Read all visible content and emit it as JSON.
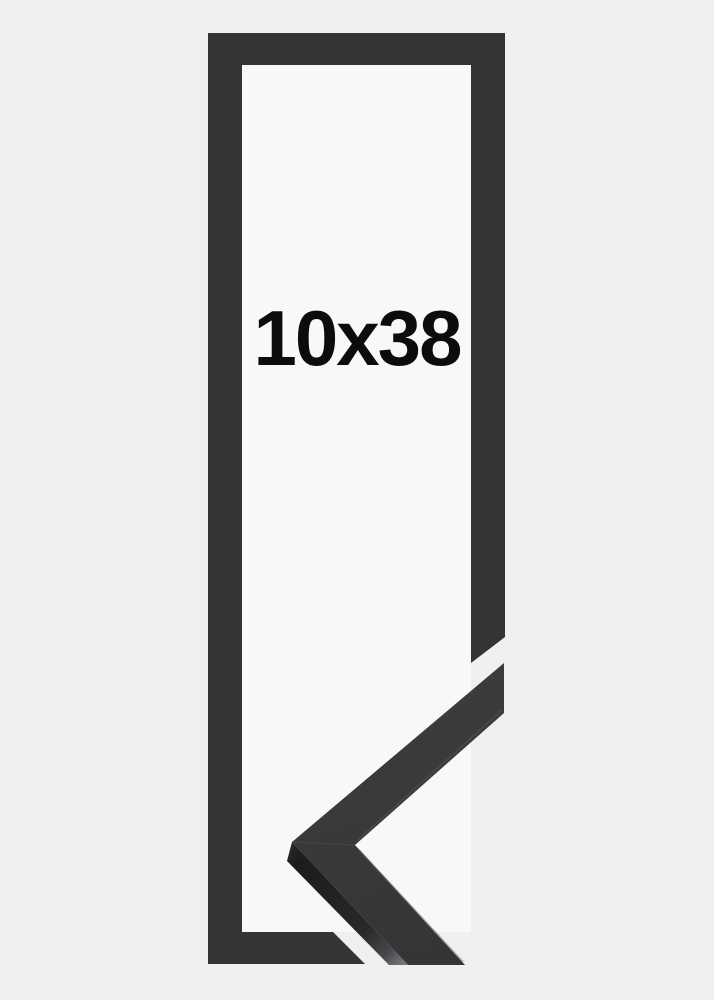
{
  "product": {
    "size_label": "10x38"
  },
  "colors": {
    "background": "#f0f0ef",
    "frame_opening": "#f8f8f7",
    "frame": "#343437",
    "corner_sample_face": "#3a3a3c",
    "corner_sample_side_dark": "#1c1c1e",
    "corner_sample_side_light": "#737376",
    "size_label_text": "#0c0c0c"
  }
}
